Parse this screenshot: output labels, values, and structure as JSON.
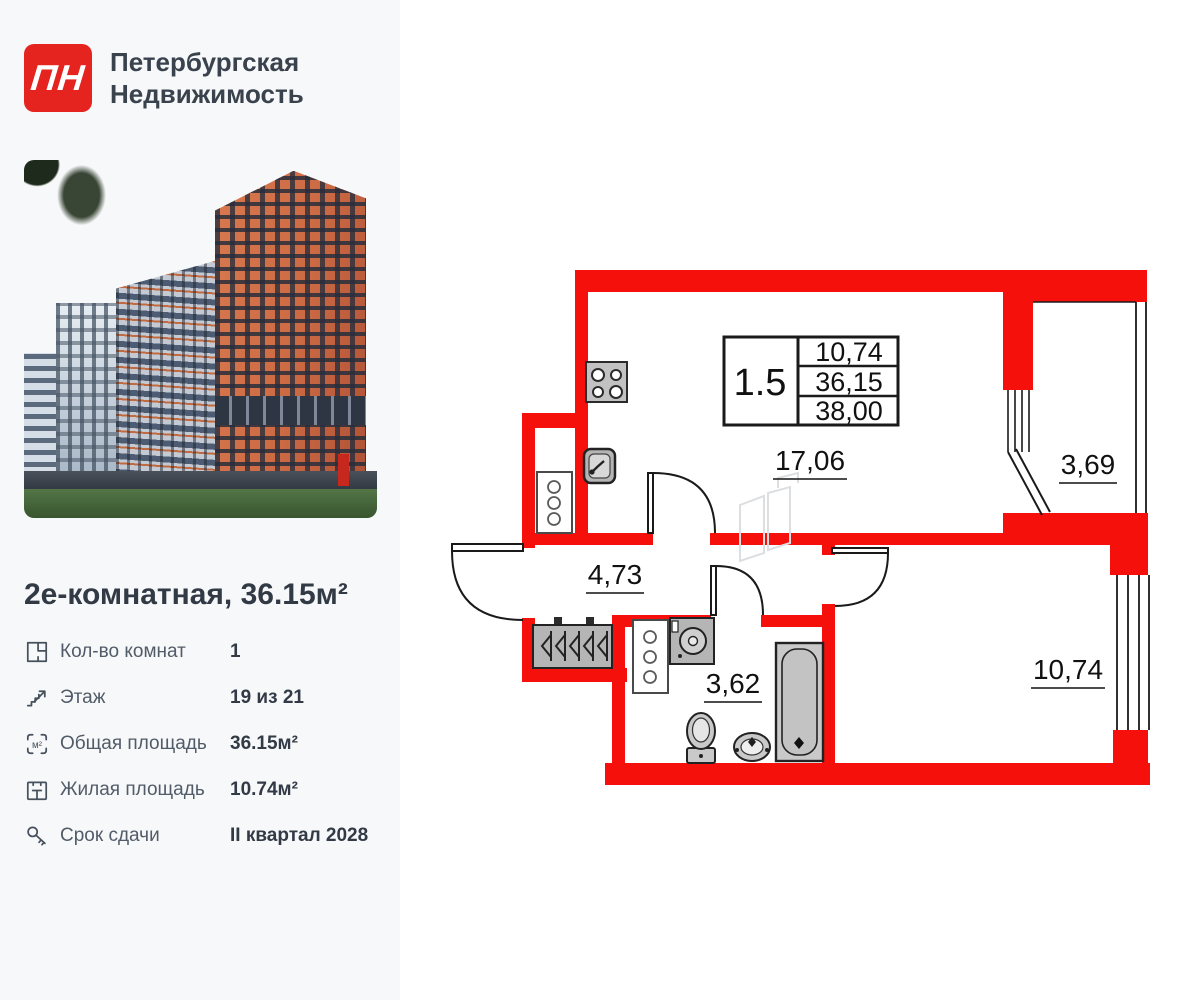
{
  "brand": {
    "mark": "ПН",
    "line1": "Петербургская",
    "line2": "Недвижимость"
  },
  "listing": {
    "title": "2е-комнатная, 36.15м²",
    "details": [
      {
        "icon": "rooms-icon",
        "label": "Кол-во комнат",
        "value": "1"
      },
      {
        "icon": "stairs-icon",
        "label": "Этаж",
        "value": "19 из 21"
      },
      {
        "icon": "total-area-icon",
        "label": "Общая площадь",
        "value": "36.15м²"
      },
      {
        "icon": "living-area-icon",
        "label": "Жилая площадь",
        "value": "10.74м²"
      },
      {
        "icon": "key-icon",
        "label": "Срок сдачи",
        "value": "II квартал 2028"
      }
    ]
  },
  "floorplan": {
    "wall_color": "#f5100c",
    "spec_table": {
      "rooms": "1.5",
      "living_area": "10,74",
      "total_area": "36,15",
      "total_reduced": "38,00"
    },
    "rooms": [
      {
        "name": "kitchen-living",
        "area": "17,06"
      },
      {
        "name": "balcony",
        "area": "3,69"
      },
      {
        "name": "hallway",
        "area": "4,73"
      },
      {
        "name": "bathroom",
        "area": "3,62"
      },
      {
        "name": "bedroom",
        "area": "10,74"
      }
    ],
    "area_icon_unit": "м²"
  },
  "colors": {
    "brand_red": "#e5241f",
    "wall_red": "#f5100c",
    "sidebar_bg": "#f7f8f9",
    "text_dark": "#323a46",
    "text_muted": "#515c68"
  }
}
